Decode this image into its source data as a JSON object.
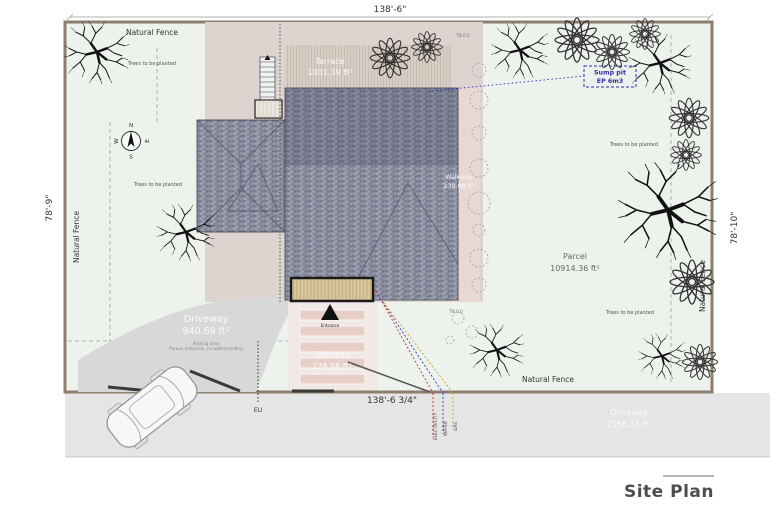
{
  "title": "Site Plan",
  "dimensions": {
    "top": "138'-6\"",
    "bottom": "138'-6 3/4\"",
    "left": "78'-9\"",
    "right": "78'-10\""
  },
  "fence": {
    "top": "Natural Fence",
    "bottom": "Natural Fence",
    "left": "Natural Fence",
    "right": "Natural Fence"
  },
  "planting": {
    "top_left": "Trees to be planted",
    "left": "Trees to be planted",
    "right_upper": "Trees to be planted",
    "right_lower": "Trees to be planted"
  },
  "areas": {
    "terrace": {
      "name": "Terrace",
      "area": "1031.39 ft²"
    },
    "side_walkway": {
      "name": "Walkway",
      "area": "239.98 ft²"
    },
    "front_walkway": {
      "name": "Walkway",
      "area": "278.88 ft²"
    },
    "driveway": {
      "name": "Driveway",
      "area": "940.69 ft²",
      "note_line1": "Parking area",
      "note_line2": "Porous materials, no waterproofing"
    },
    "street_driveway": {
      "name": "Driveway",
      "area": "2156.73 ft²"
    },
    "parcel": {
      "name": "Parcel",
      "area": "10914.36 ft²"
    }
  },
  "markers": {
    "sump_pit_line1": "Sump pit",
    "sump_pit_line2": "EP 6m3",
    "eu": "EU",
    "tn_top": "TN 0.0",
    "tn_bottom": "TN 0.0",
    "entrance": "Entrance"
  },
  "utilities": {
    "electricity": "ELECTRICITY",
    "water": "WATER",
    "gas": "GAS"
  },
  "compass": {
    "n": "N",
    "s": "S",
    "e": "E",
    "w": "W"
  },
  "colors": {
    "parcel_fill": "#edf2ed",
    "beige": "#ddd3cf",
    "roof_base": "#8b8f9f",
    "driveway": "#d8d8d8",
    "street_strip": "#e5e5e5",
    "fence_border": "#8d7e6e",
    "electricity_line": "#cc2b2b",
    "water_line": "#2b3bbf",
    "gas_line": "#c9a227",
    "sump_blue": "#2f2fae"
  }
}
